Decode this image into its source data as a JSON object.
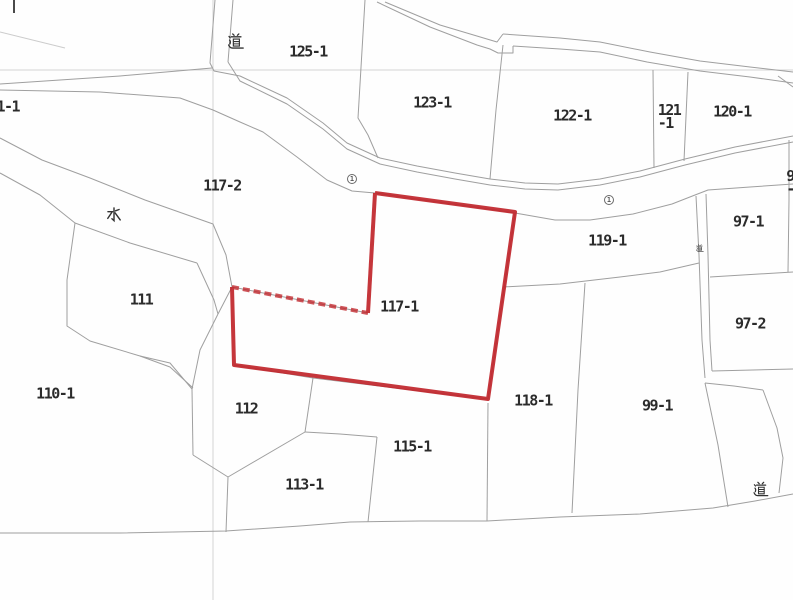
{
  "map": {
    "title": "cadastral parcel map",
    "background_color": "#fefefe",
    "boundary_line_color": "#9f9f9f",
    "grid_line_color": "#d4d4d4",
    "label_color": "#2b2b2b",
    "highlight": {
      "parcel_id": "117-1",
      "outline_color": "#c1272d"
    },
    "road_markers": [
      {
        "symbol": "circled-1",
        "digit": "1",
        "x": 352,
        "y": 179
      },
      {
        "symbol": "circled-1",
        "digit": "1",
        "x": 609,
        "y": 200
      }
    ],
    "kanji_labels": [
      {
        "id": "road-top",
        "text": "道",
        "x": 236,
        "y": 41,
        "size": 17
      },
      {
        "id": "water",
        "text": "水",
        "x": 114,
        "y": 215,
        "size": 17
      },
      {
        "id": "road-small",
        "text": "道",
        "x": 700,
        "y": 248,
        "size": 8
      },
      {
        "id": "road-bottom-right",
        "text": "道",
        "x": 761,
        "y": 489,
        "size": 16
      }
    ],
    "parcel_labels": [
      {
        "id": "125-1",
        "text": "125-1",
        "x": 308,
        "y": 52
      },
      {
        "id": "61-1",
        "text": "61-1",
        "x": 4,
        "y": 107,
        "clipped": "left"
      },
      {
        "id": "123-1",
        "text": "123-1",
        "x": 432,
        "y": 103
      },
      {
        "id": "122-1",
        "text": "122-1",
        "x": 572,
        "y": 116
      },
      {
        "id": "121-1",
        "text": "121\n-1",
        "x": 669,
        "y": 117
      },
      {
        "id": "120-1",
        "text": "120-1",
        "x": 732,
        "y": 112
      },
      {
        "id": "117-2",
        "text": "117-2",
        "x": 222,
        "y": 186
      },
      {
        "id": "119-1",
        "text": "119-1",
        "x": 607,
        "y": 241
      },
      {
        "id": "97-1",
        "text": "97-1",
        "x": 748,
        "y": 222
      },
      {
        "id": "9-edge",
        "text": "9\n-",
        "x": 790,
        "y": 183,
        "clipped": "right"
      },
      {
        "id": "97-2",
        "text": "97-2",
        "x": 750,
        "y": 324
      },
      {
        "id": "111",
        "text": "111",
        "x": 141,
        "y": 300
      },
      {
        "id": "117-1",
        "text": "117-1",
        "x": 399,
        "y": 307
      },
      {
        "id": "110-1",
        "text": "110-1",
        "x": 55,
        "y": 394
      },
      {
        "id": "112",
        "text": "112",
        "x": 246,
        "y": 409
      },
      {
        "id": "118-1",
        "text": "118-1",
        "x": 533,
        "y": 401
      },
      {
        "id": "99-1",
        "text": "99-1",
        "x": 657,
        "y": 406
      },
      {
        "id": "115-1",
        "text": "115-1",
        "x": 412,
        "y": 447
      },
      {
        "id": "113-1",
        "text": "113-1",
        "x": 304,
        "y": 485
      }
    ]
  }
}
